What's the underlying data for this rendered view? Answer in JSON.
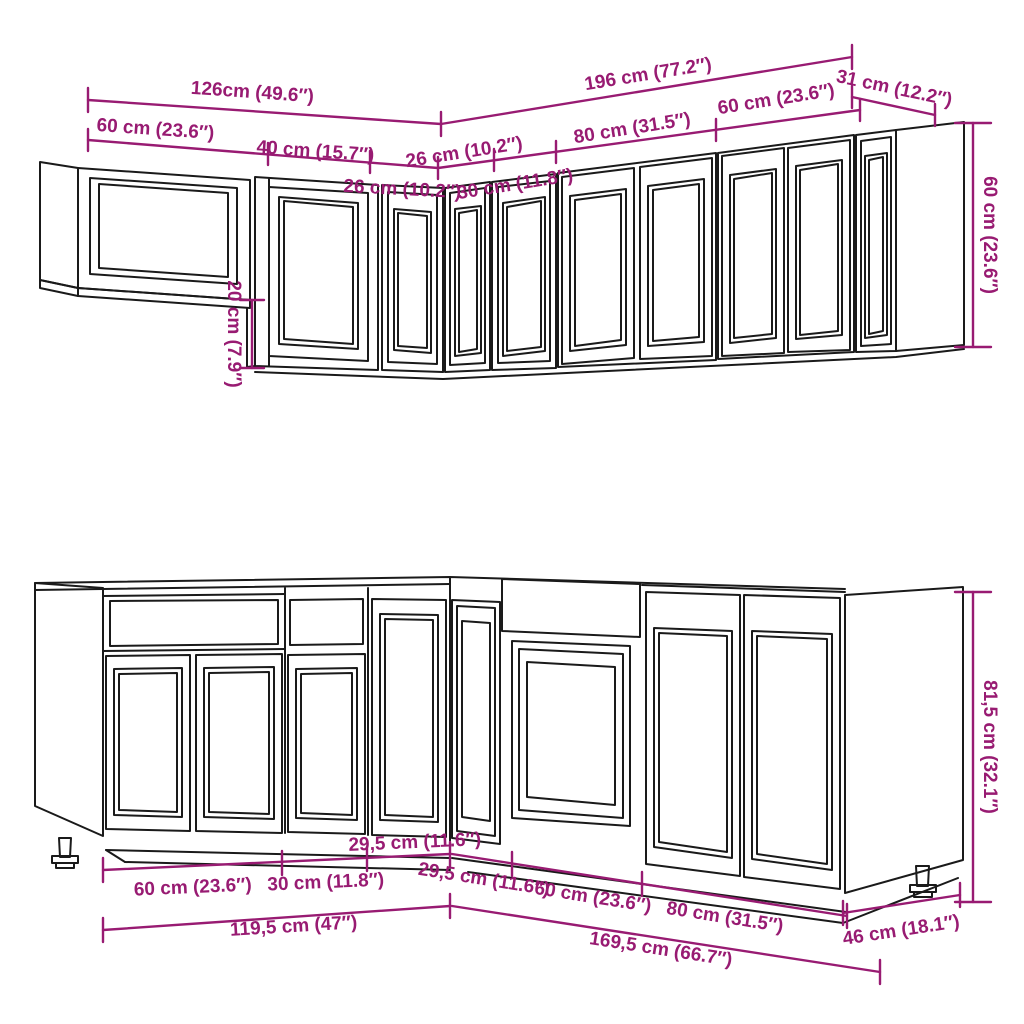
{
  "diagram": {
    "kind": "kitchen-cabinet-set-dimension-diagram",
    "colors": {
      "dimension": "#981B72",
      "line": "#1A1A1A",
      "background": "#FFFFFF"
    },
    "dims": {
      "upper_total_left": "126cm (49.6″)",
      "upper_total_right": "196 cm (77.2″)",
      "upper_end_31": "31 cm (12.2″)",
      "upper_w60_left": "60 cm (23.6″)",
      "upper_w40": "40 cm (15.7″)",
      "upper_w26_left": "26 cm (10.2″)",
      "upper_w26_right": "26 cm (10.2″)",
      "upper_w30": "30 cm (11.8″)",
      "upper_w80": "80 cm (31.5″)",
      "upper_w60_right": "60 cm (23.6″)",
      "upper_height": "60 cm (23.6″)",
      "upper_drop": "20 cm (7.9″)",
      "lower_w60_left": "60 cm (23.6″)",
      "lower_w30": "30 cm (11.8″)",
      "lower_w295_left": "29,5 cm (11.6″)",
      "lower_w295_right": "29,5 cm (11.6″)",
      "lower_w60_right": "60 cm (23.6″)",
      "lower_w80": "80 cm (31.5″)",
      "lower_total_left": "119,5 cm (47″)",
      "lower_total_right": "169,5 cm (66.7″)",
      "lower_depth_46": "46 cm (18.1″)",
      "lower_height": "81,5 cm (32.1″)"
    }
  }
}
